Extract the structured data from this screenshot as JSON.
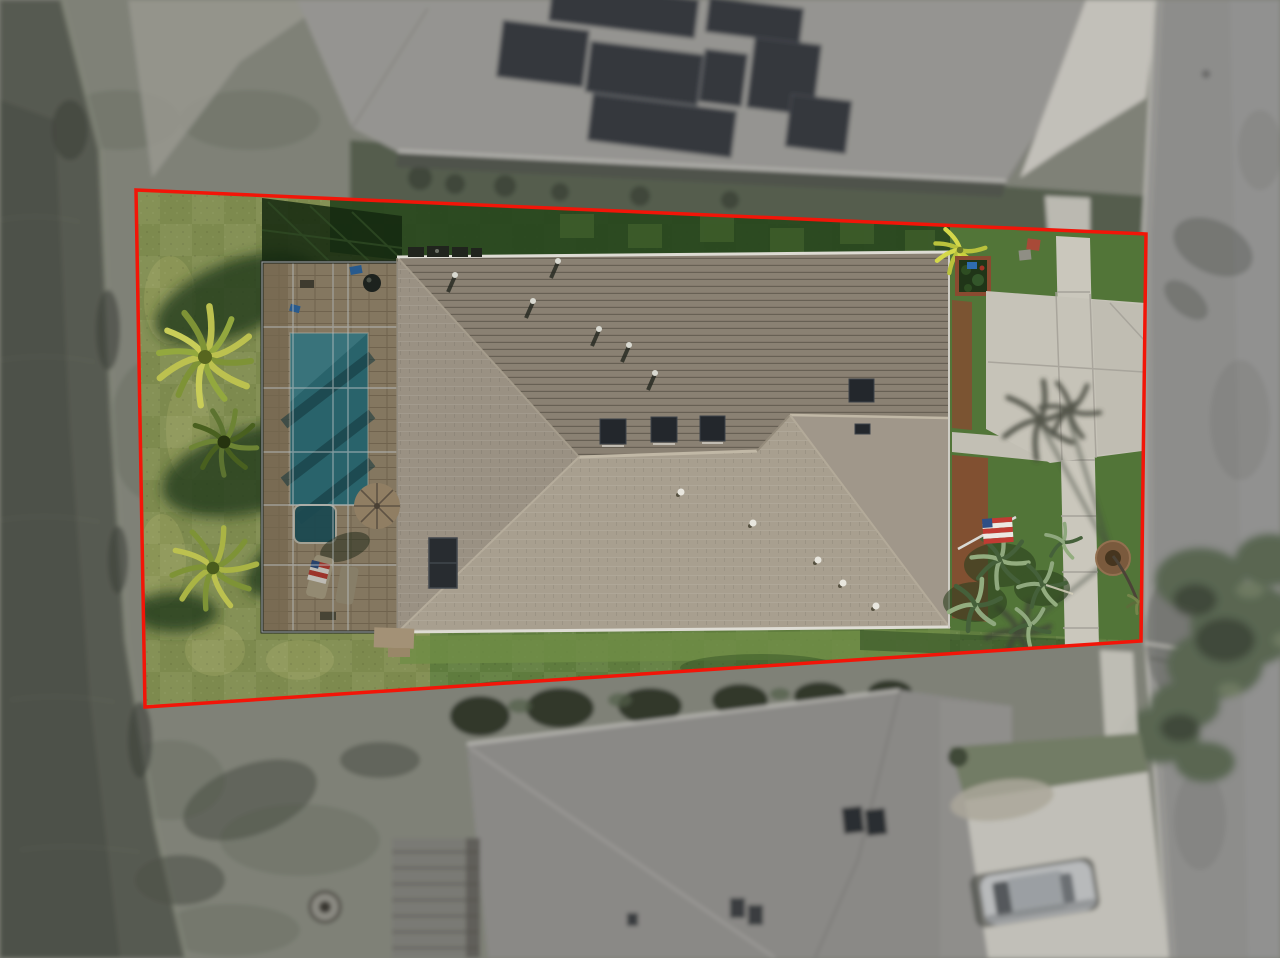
{
  "image": {
    "width": 1280,
    "height": 958,
    "kind": "aerial-drone-photo",
    "subject": "single-family home lot outlined in red: screened pool lanai, gray shingle hip roof, lake frontage on left, street on right, neighboring roofs top (with solar panels) and bottom"
  },
  "boundary": {
    "color": "#f21508",
    "stroke_width": 3.5,
    "corners": {
      "top_left": [
        136,
        190
      ],
      "top_right": [
        1146,
        234
      ],
      "bottom_right": [
        1141,
        641
      ],
      "bottom_left": [
        145,
        707
      ]
    }
  },
  "colors": {
    "water": "#565b4d",
    "water_deep": "#4b5045",
    "bank_grass": "#7e8272",
    "bank_dark": "#6d7263",
    "bank_path": "#9a988c",
    "neighbor_roof_top": "#96948f",
    "neighbor_roof_bottom": "#8b8985",
    "solar_panel": "#34383e",
    "street_asphalt": "#8d8d8b",
    "curb_concrete": "#b8b6ad",
    "sidewalk_concrete": "#cac7bc",
    "driveway_concrete": "#c6c3b8",
    "concrete_joint": "#a5a299",
    "lawn_mid": "#5f7c3e",
    "lawn_sunlit": "#7d8a4e",
    "lawn_shadow": "#28461f",
    "lawn_front": "#527538",
    "roof_upper": "#8a8173",
    "roof_left": "#9a9183",
    "roof_lower": "#a89f8f",
    "roof_right": "#a0978a",
    "roof_ridge": "#c1b8a6",
    "gutter_white": "#dedcd4",
    "skylight_dark": "#23272c",
    "pool_water": "#2f7884",
    "pool_shadow": "#16444f",
    "spa_water": "#1d5763",
    "paver_tan": "#a39176",
    "enclosure_frame": "#b9bfc2",
    "umbrella_tan": "#907e63",
    "mulch_red": "#8a4a30",
    "plant_yellow": "#cdd23e",
    "palm_yellow": "#bcc14f",
    "palm_green": "#7e9336",
    "palmetto_green": "#8fa87e",
    "flag_red": "#c23b33",
    "flag_white": "#ece8e2",
    "flag_blue": "#2e4f86",
    "canopy_green": "#55684a",
    "tree_shadow": "#2e3a27",
    "car_silver": "#b7babc"
  },
  "features": {
    "backyard_palm_count": 3,
    "pool": "rectangular pool with spa inside screened lanai",
    "flag": "US flag mounted on front of house",
    "street_light": "street light at lower-right lot corner",
    "parked_car": "silver car on neighbor driveway bottom-right"
  }
}
